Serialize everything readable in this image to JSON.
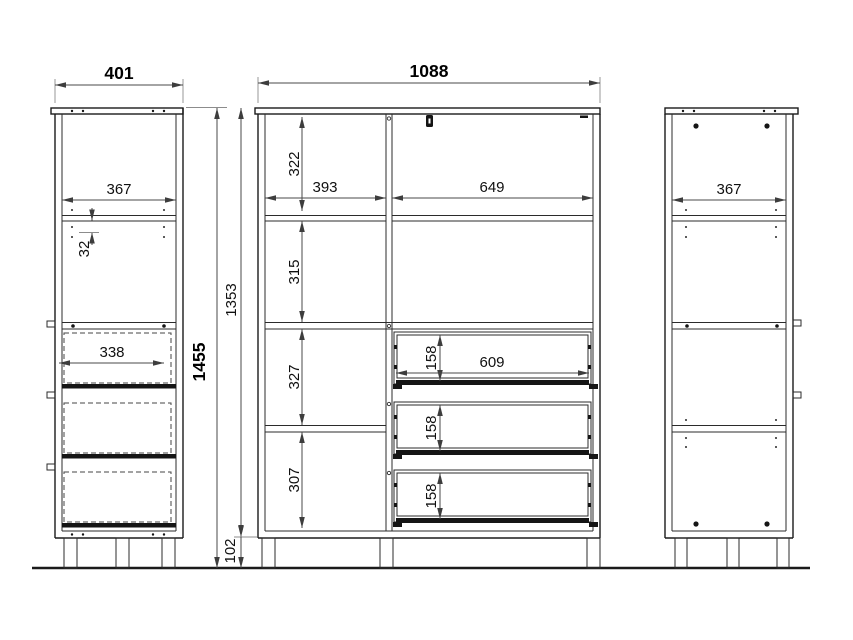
{
  "drawing": {
    "left_view": {
      "total_width": "401",
      "inner_width": "367",
      "hole_pitch": "32",
      "drawer_depth": "338",
      "total_height": "1455"
    },
    "front_view": {
      "total_width": "1088",
      "section_1_height": "322",
      "left_opening_width": "393",
      "right_opening_width": "649",
      "section_2_height": "315",
      "section_3_height": "327",
      "section_4_height": "307",
      "body_height": "1353",
      "leg_height": "102",
      "drawer_opening_width": "609",
      "drawer_front_heights": [
        "158",
        "158",
        "158"
      ]
    },
    "right_view": {
      "inner_width": "367"
    }
  }
}
